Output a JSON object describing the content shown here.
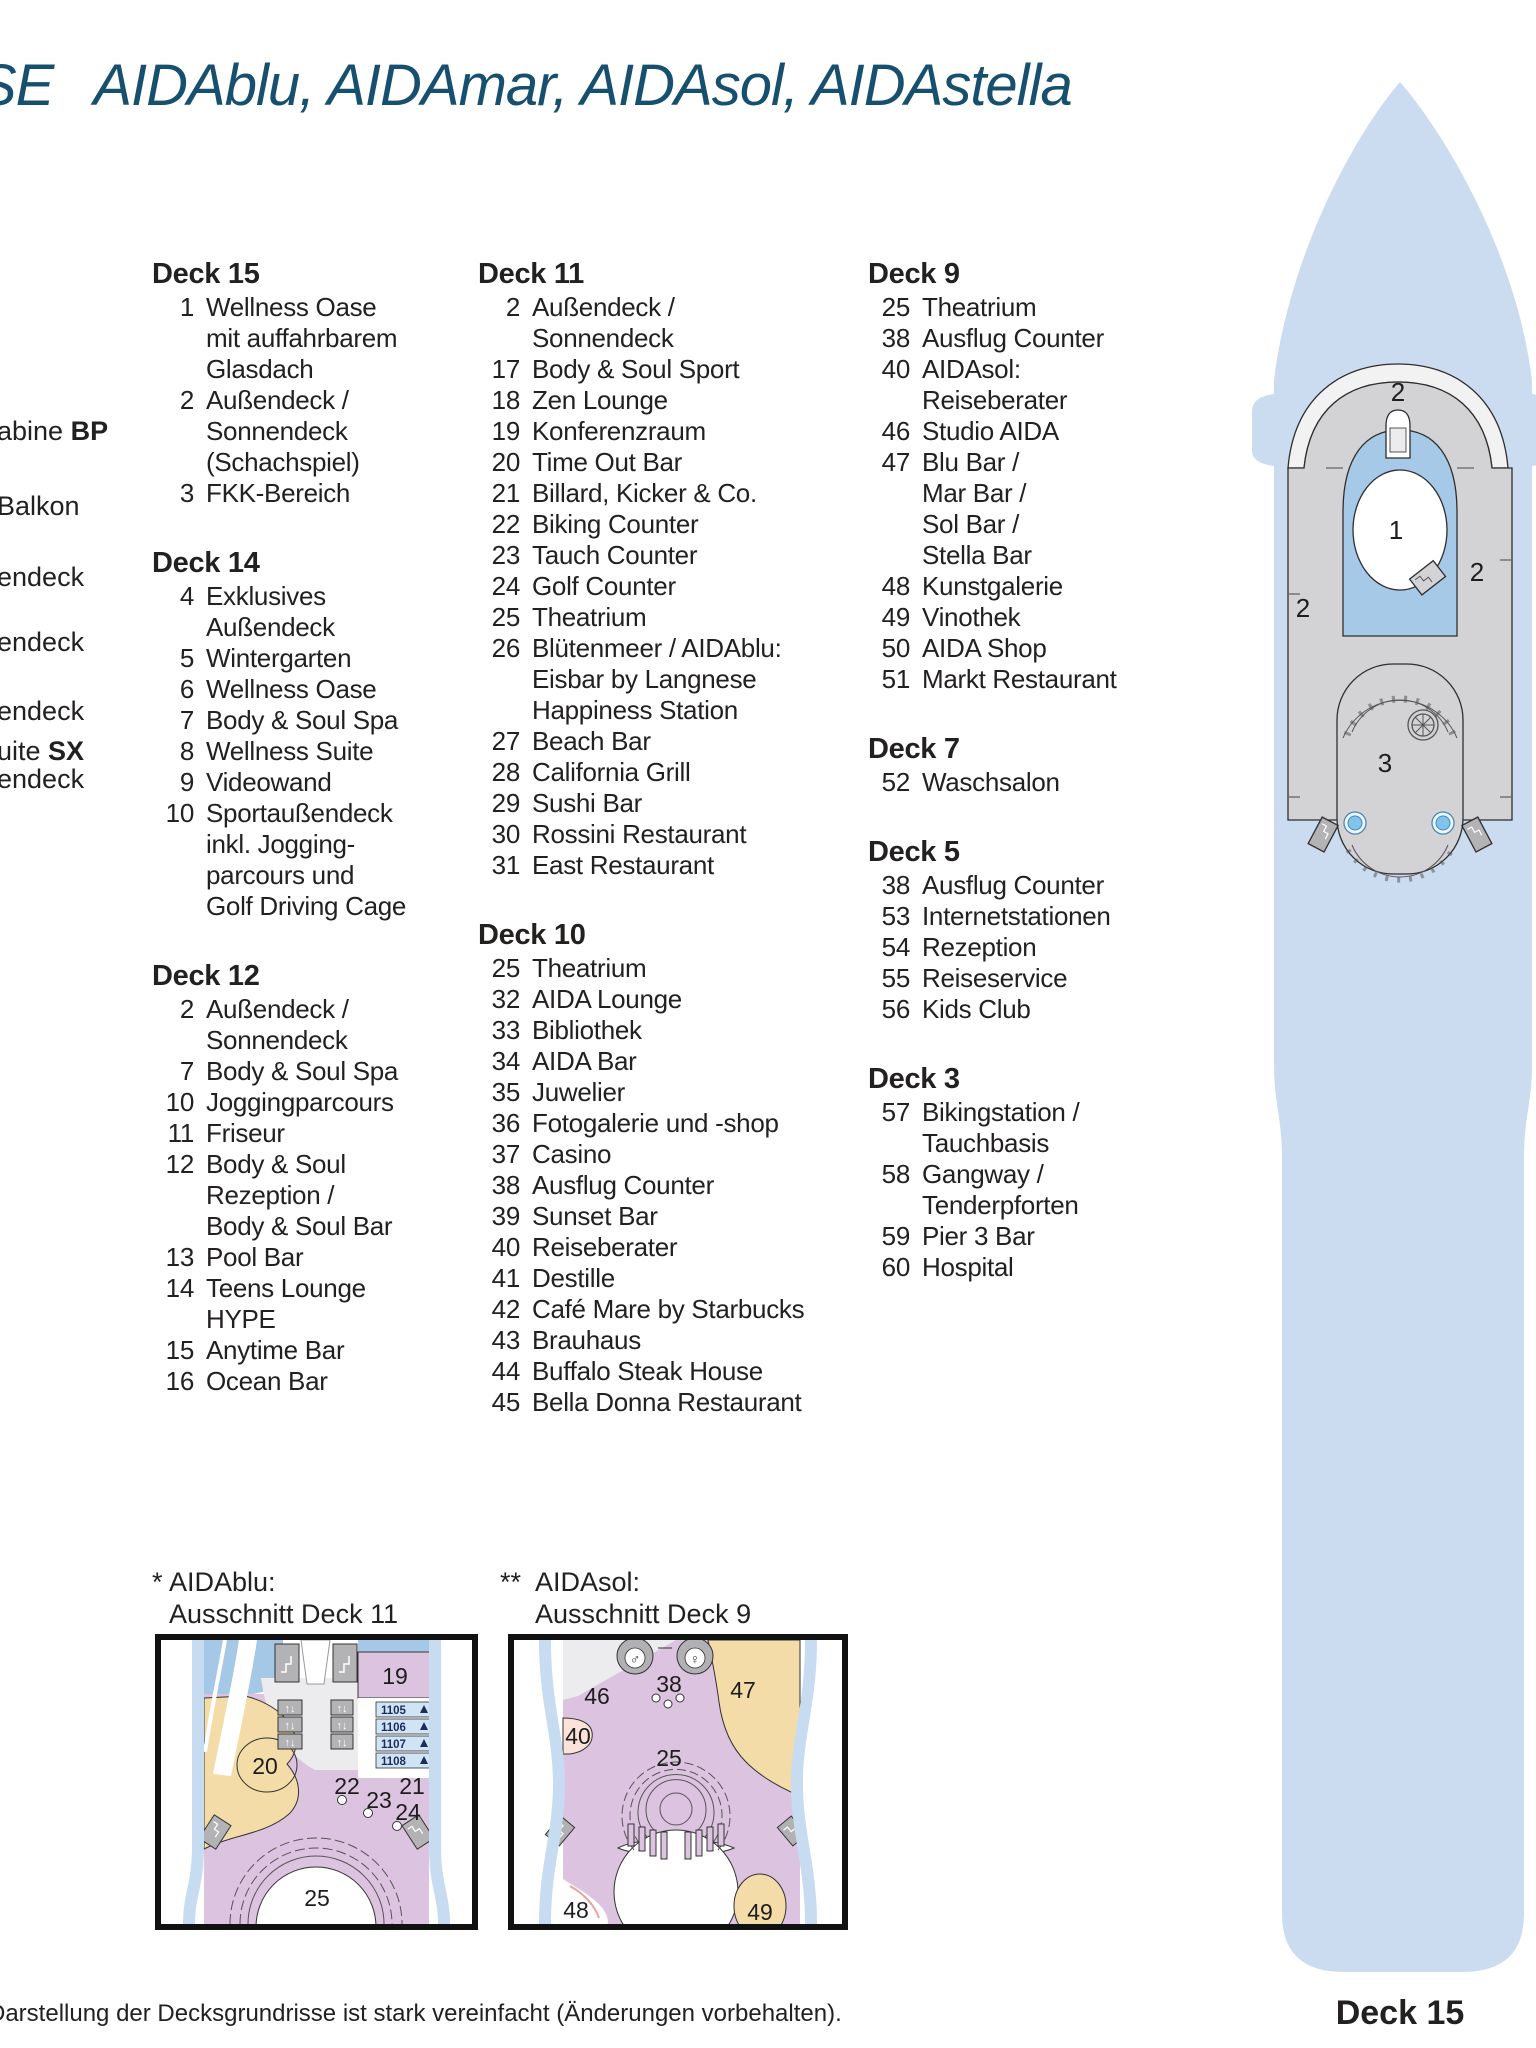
{
  "header": {
    "title_fragment": "SE",
    "title_ships": "AIDAblu, AIDAmar, AIDAsol, AIDAstella"
  },
  "colors": {
    "title_blue": "#17506e",
    "hull_blue": "#ccdcf0",
    "deck_gray": "#d3d3d5",
    "pool_blue": "#a6c9e8",
    "area_purple": "#dcc3df",
    "area_tan": "#f3dca7",
    "cabin_blue": "#cfe4f5",
    "text_dark": "#232020"
  },
  "left_legend_fragments": [
    {
      "text": "abine ",
      "bold": "BP"
    },
    {
      "text": "Balkon",
      "bold": ""
    },
    {
      "text": "endeck",
      "bold": ""
    },
    {
      "text": "endeck",
      "bold": ""
    },
    {
      "text": "endeck",
      "bold": ""
    },
    {
      "text": "uite ",
      "bold": "SX"
    },
    {
      "text": "endeck",
      "bold": ""
    }
  ],
  "deck_columns": [
    {
      "sections": [
        {
          "title": "Deck 15",
          "items": [
            {
              "num": "1",
              "lines": [
                "Wellness Oase",
                "mit auffahrbarem",
                "Glasdach"
              ]
            },
            {
              "num": "2",
              "lines": [
                "Außendeck /",
                "Sonnendeck",
                "(Schachspiel)"
              ]
            },
            {
              "num": "3",
              "lines": [
                "FKK-Bereich"
              ]
            }
          ]
        },
        {
          "title": "Deck 14",
          "items": [
            {
              "num": "4",
              "lines": [
                "Exklusives",
                "Außendeck"
              ]
            },
            {
              "num": "5",
              "lines": [
                "Wintergarten"
              ]
            },
            {
              "num": "6",
              "lines": [
                "Wellness Oase"
              ]
            },
            {
              "num": "7",
              "lines": [
                "Body & Soul Spa"
              ]
            },
            {
              "num": "8",
              "lines": [
                "Wellness Suite"
              ]
            },
            {
              "num": "9",
              "lines": [
                "Videowand"
              ]
            },
            {
              "num": "10",
              "lines": [
                "Sportaußendeck",
                "inkl. Jogging-",
                "parcours und",
                "Golf Driving Cage"
              ]
            }
          ]
        },
        {
          "title": "Deck 12",
          "items": [
            {
              "num": "2",
              "lines": [
                "Außendeck /",
                "Sonnendeck"
              ]
            },
            {
              "num": "7",
              "lines": [
                "Body & Soul Spa"
              ]
            },
            {
              "num": "10",
              "lines": [
                "Joggingparcours"
              ]
            },
            {
              "num": "11",
              "lines": [
                "Friseur"
              ]
            },
            {
              "num": "12",
              "lines": [
                "Body & Soul",
                "Rezeption /",
                "Body & Soul Bar"
              ]
            },
            {
              "num": "13",
              "lines": [
                "Pool Bar"
              ]
            },
            {
              "num": "14",
              "lines": [
                "Teens Lounge",
                "HYPE"
              ]
            },
            {
              "num": "15",
              "lines": [
                "Anytime Bar"
              ]
            },
            {
              "num": "16",
              "lines": [
                "Ocean Bar"
              ]
            }
          ]
        }
      ]
    },
    {
      "sections": [
        {
          "title": "Deck 11",
          "items": [
            {
              "num": "2",
              "lines": [
                "Außendeck /",
                "Sonnendeck"
              ]
            },
            {
              "num": "17",
              "lines": [
                "Body & Soul Sport"
              ]
            },
            {
              "num": "18",
              "lines": [
                "Zen Lounge"
              ]
            },
            {
              "num": "19",
              "lines": [
                "Konferenzraum"
              ]
            },
            {
              "num": "20",
              "lines": [
                "Time Out Bar"
              ]
            },
            {
              "num": "21",
              "lines": [
                "Billard, Kicker & Co."
              ]
            },
            {
              "num": "22",
              "lines": [
                "Biking Counter"
              ]
            },
            {
              "num": "23",
              "lines": [
                "Tauch Counter"
              ]
            },
            {
              "num": "24",
              "lines": [
                "Golf Counter"
              ]
            },
            {
              "num": "25",
              "lines": [
                "Theatrium"
              ]
            },
            {
              "num": "26",
              "lines": [
                "Blütenmeer / AIDAblu:",
                "Eisbar by Langnese",
                "Happiness Station"
              ]
            },
            {
              "num": "27",
              "lines": [
                "Beach Bar"
              ]
            },
            {
              "num": "28",
              "lines": [
                "California Grill"
              ]
            },
            {
              "num": "29",
              "lines": [
                "Sushi Bar"
              ]
            },
            {
              "num": "30",
              "lines": [
                "Rossini Restaurant"
              ]
            },
            {
              "num": "31",
              "lines": [
                "East Restaurant"
              ]
            }
          ]
        },
        {
          "title": "Deck 10",
          "items": [
            {
              "num": "25",
              "lines": [
                "Theatrium"
              ]
            },
            {
              "num": "32",
              "lines": [
                "AIDA Lounge"
              ]
            },
            {
              "num": "33",
              "lines": [
                "Bibliothek"
              ]
            },
            {
              "num": "34",
              "lines": [
                "AIDA Bar"
              ]
            },
            {
              "num": "35",
              "lines": [
                "Juwelier"
              ]
            },
            {
              "num": "36",
              "lines": [
                "Fotogalerie und -shop"
              ]
            },
            {
              "num": "37",
              "lines": [
                "Casino"
              ]
            },
            {
              "num": "38",
              "lines": [
                "Ausflug Counter"
              ]
            },
            {
              "num": "39",
              "lines": [
                "Sunset Bar"
              ]
            },
            {
              "num": "40",
              "lines": [
                "Reiseberater"
              ]
            },
            {
              "num": "41",
              "lines": [
                "Destille"
              ]
            },
            {
              "num": "42",
              "lines": [
                "Café Mare by Starbucks"
              ]
            },
            {
              "num": "43",
              "lines": [
                "Brauhaus"
              ]
            },
            {
              "num": "44",
              "lines": [
                "Buffalo Steak House"
              ]
            },
            {
              "num": "45",
              "lines": [
                "Bella Donna Restaurant"
              ]
            }
          ]
        }
      ]
    },
    {
      "sections": [
        {
          "title": "Deck 9",
          "items": [
            {
              "num": "25",
              "lines": [
                "Theatrium"
              ]
            },
            {
              "num": "38",
              "lines": [
                "Ausflug Counter"
              ]
            },
            {
              "num": "40",
              "lines": [
                "AIDAsol:",
                "Reiseberater"
              ]
            },
            {
              "num": "46",
              "lines": [
                "Studio AIDA"
              ]
            },
            {
              "num": "47",
              "lines": [
                "Blu Bar /",
                "Mar Bar /",
                "Sol Bar /",
                "Stella Bar"
              ]
            },
            {
              "num": "48",
              "lines": [
                "Kunstgalerie"
              ]
            },
            {
              "num": "49",
              "lines": [
                "Vinothek"
              ]
            },
            {
              "num": "50",
              "lines": [
                "AIDA Shop"
              ]
            },
            {
              "num": "51",
              "lines": [
                "Markt Restaurant"
              ]
            }
          ]
        },
        {
          "title": "Deck 7",
          "items": [
            {
              "num": "52",
              "lines": [
                "Waschsalon"
              ]
            }
          ]
        },
        {
          "title": "Deck 5",
          "items": [
            {
              "num": "38",
              "lines": [
                "Ausflug Counter"
              ]
            },
            {
              "num": "53",
              "lines": [
                "Internetstationen"
              ]
            },
            {
              "num": "54",
              "lines": [
                "Rezeption"
              ]
            },
            {
              "num": "55",
              "lines": [
                "Reiseservice"
              ]
            },
            {
              "num": "56",
              "lines": [
                "Kids Club"
              ]
            }
          ]
        },
        {
          "title": "Deck 3",
          "items": [
            {
              "num": "57",
              "lines": [
                "Bikingstation /",
                "Tauchbasis"
              ]
            },
            {
              "num": "58",
              "lines": [
                "Gangway /",
                "Tenderpforten"
              ]
            },
            {
              "num": "59",
              "lines": [
                "Pier 3 Bar"
              ]
            },
            {
              "num": "60",
              "lines": [
                "Hospital"
              ]
            }
          ]
        }
      ]
    }
  ],
  "ship_plan": {
    "labels": {
      "bow_deck": "2",
      "pool": "1",
      "port_deck": "2",
      "starboard_deck": "2",
      "fkk_area": "3"
    }
  },
  "insets": [
    {
      "marker": "*",
      "ship": "AIDAblu:",
      "caption": "Ausschnitt Deck 11",
      "labels": {
        "l19": "19",
        "l20": "20",
        "l21": "21",
        "l22": "22",
        "l23": "23",
        "l24": "24",
        "l25": "25"
      },
      "cabins": [
        {
          "num": "1105"
        },
        {
          "num": "1106"
        },
        {
          "num": "1107"
        },
        {
          "num": "1108"
        }
      ]
    },
    {
      "marker": "**",
      "ship": "AIDAsol:",
      "caption": "Ausschnitt Deck 9",
      "labels": {
        "l46": "46",
        "l40": "40",
        "l38": "38",
        "l47": "47",
        "l25": "25",
        "l48": "48",
        "l49": "49"
      }
    }
  ],
  "footer": {
    "note": "Darstellung der Decksgrundrisse ist stark vereinfacht (Änderungen vorbehalten).",
    "deck_label": "Deck 15"
  }
}
